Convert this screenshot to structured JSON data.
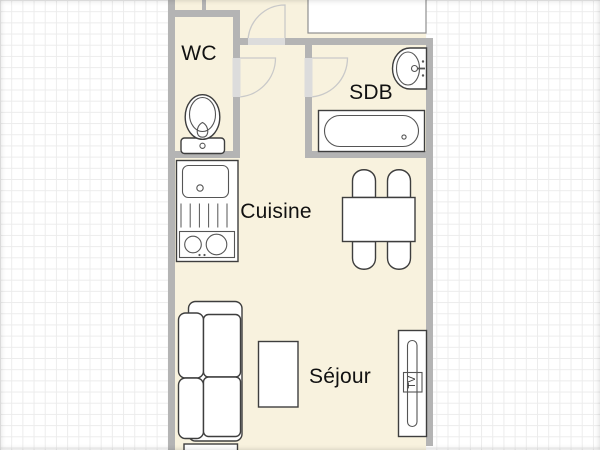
{
  "plan": {
    "type": "apartment-floor-plan",
    "rooms": {
      "wc": {
        "label": "WC"
      },
      "sdb": {
        "label": "SDB"
      },
      "cuisine": {
        "label": "Cuisine"
      },
      "sejour": {
        "label": "Séjour"
      }
    },
    "furniture": {
      "tv_label": "TV",
      "items": [
        "toilet",
        "kitchen-sink-unit",
        "dining-table",
        "four-chairs",
        "bathtub",
        "washbasin",
        "sofa",
        "coffee-table",
        "tv-stand"
      ]
    },
    "doors": [
      "entry-door",
      "wc-door",
      "sdb-door"
    ],
    "colors": {
      "floor": "#f8f2de",
      "wall": "#b4b4b4",
      "door_trim": "#dcdcdc",
      "door_arc": "#c9c9c9",
      "furniture_outline": "#3e3e3e",
      "grid_line": "#ececec",
      "background": "#ffffff",
      "label_text": "#111111"
    }
  }
}
